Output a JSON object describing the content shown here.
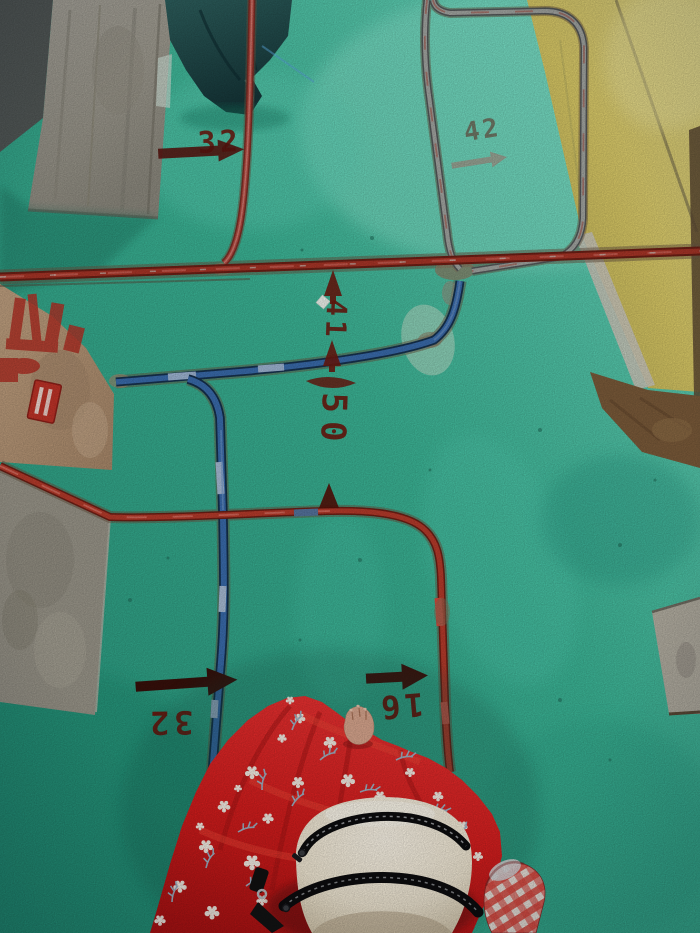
{
  "scene": {
    "description": "First-person photo looking down at a green-painted concrete floor during electrical conduit rough-in; red and blue conduits run in chases, dimension numbers are stenciled in dark red, a person in a red floral dress carries a white waist bag.",
    "floor_paint": "green",
    "wall_paint": "yellow"
  },
  "colors": {
    "floor_green": "#3cb697",
    "floor_highlight": "#8fe9d2",
    "wall_yellow": "#ddc966",
    "concrete_gray": "#a29d93",
    "ledge_tan": "#b89876",
    "conduit_red": "#b73b2b",
    "conduit_blue": "#3a6cad",
    "stencil_maroon": "#6d1a10",
    "dress_red": "#d31d1d",
    "bag_cream": "#efe6d2",
    "tarp_teal": "#265553",
    "plaid_red": "#d8453c"
  },
  "markings": {
    "top_left": {
      "value": "32",
      "arrow": "right"
    },
    "top_right": {
      "value": "42",
      "arrow": "right"
    },
    "center_upper": {
      "value": "41",
      "arrow": "up"
    },
    "center_lower": {
      "value": "50",
      "arrow": "up"
    },
    "bottom_left": {
      "value": "32",
      "arrow": "right"
    },
    "bottom_center": {
      "value": "16",
      "arrow": "right"
    }
  }
}
